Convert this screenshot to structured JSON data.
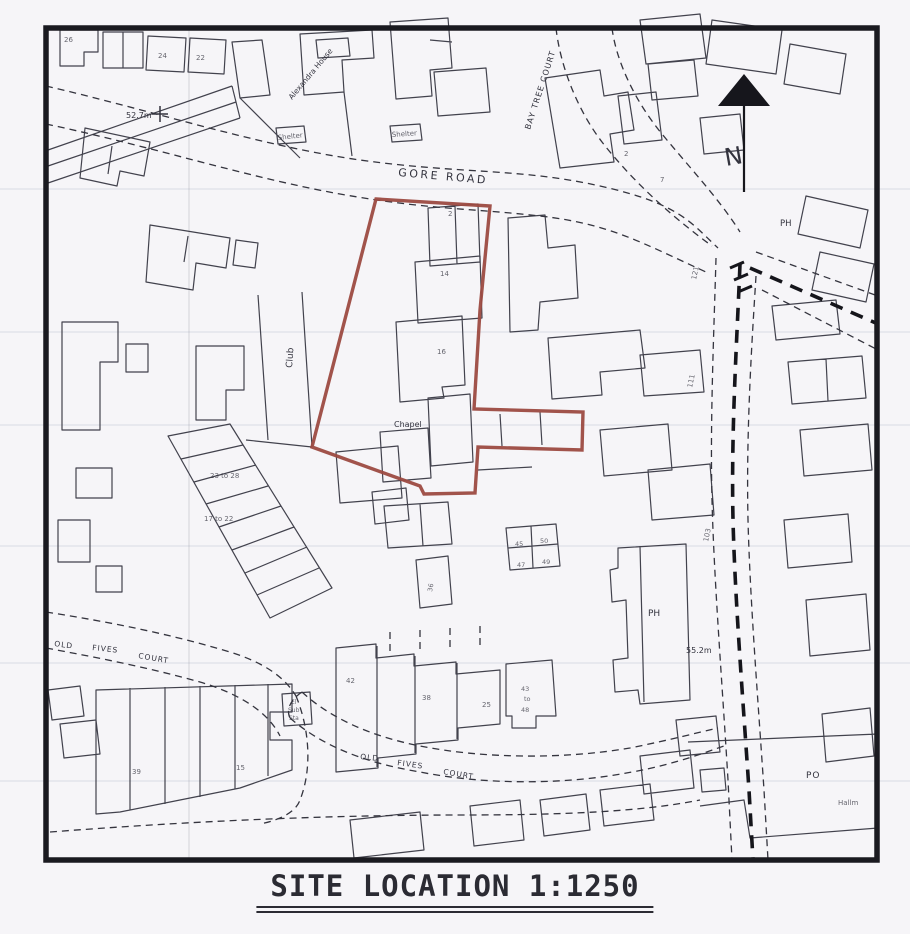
{
  "page": {
    "caption": "SITE LOCATION 1:1250"
  },
  "map": {
    "north_label": "N",
    "roads": {
      "gore_road": "GORE ROAD",
      "bay_tree_court": "BAY TREE COURT",
      "old_fives_court_w": [
        "OLD",
        "FIVES",
        "COURT"
      ],
      "old_fives_court_s": [
        "OLD",
        "FIVES",
        "COURT"
      ]
    },
    "places": {
      "club": "Club",
      "chapel": "Chapel",
      "alexandra_house": "Alexandra House",
      "shelter_w": "Shelter",
      "shelter_e": "Shelter",
      "ph_north": "PH",
      "ph_south": "PH",
      "po": "PO",
      "hallmark": "Hallm",
      "sub_station": [
        "El",
        "Sub",
        "Sta"
      ]
    },
    "benchmarks": {
      "bm_52": "52.7m",
      "bm_55": "55.2m"
    },
    "house_numbers": {
      "n26": "26",
      "n24": "24",
      "n22": "22",
      "n2_top": "2",
      "n7": "7",
      "r23_28": "23 to 28",
      "r17_22": "17 to 22",
      "n42": "42",
      "n38": "38",
      "n25": "25",
      "r43_48": [
        "43",
        "to",
        "48"
      ],
      "n39": "39",
      "n15": "15",
      "g45": "45",
      "g50": "50",
      "g47": "47",
      "g49": "49",
      "n2_site": "2",
      "n14": "14",
      "n16": "16",
      "n121": "121",
      "n111": "111",
      "n103": "103",
      "n36": "36"
    },
    "colors": {
      "site_boundary": "#9c4a41",
      "linework": "#3f3f4a",
      "paper": "#f6f5f8",
      "frame": "#1a1a20"
    }
  }
}
